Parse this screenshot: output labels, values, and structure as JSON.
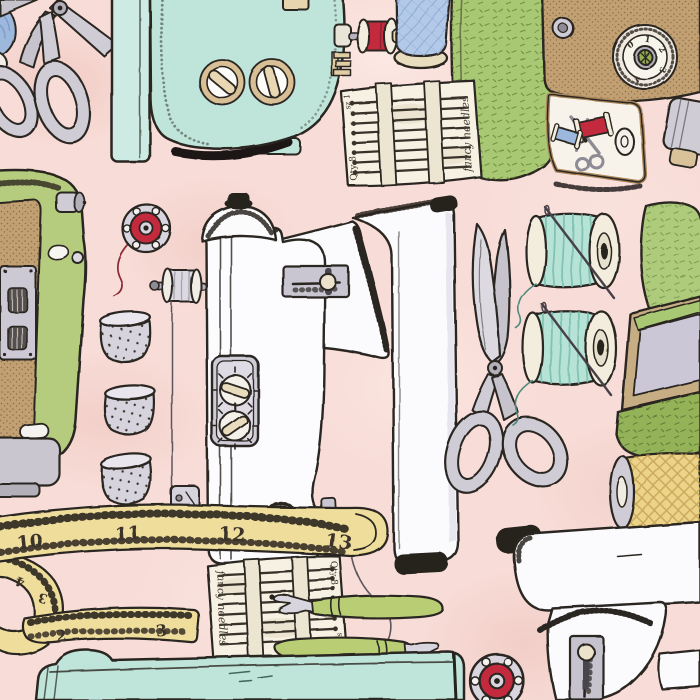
{
  "artwork": {
    "title": "Hand-drawn vintage sewing notions pattern on pink",
    "background_color": "#f8dcd7",
    "palette": {
      "ink": "#2a2520",
      "pink_background": "#f8dcd7",
      "teal_machine": "#bfe5da",
      "aqua_thread": "#b7e3d7",
      "avocado_green": "#b5cc7e",
      "olive_green": "#94b359",
      "leaf_green": "#a9c873",
      "brown": "#c2a072",
      "tan": "#e6d5ae",
      "cream": "#f6f1e3",
      "silver": "#cfccd6",
      "lavender": "#cbc7d6",
      "red": "#c32b3e",
      "blue": "#9db8dd",
      "yellow": "#efdd9b"
    },
    "needle_packet": {
      "qty_label": "Qty 8",
      "size_label": "sz 1",
      "brand_label": "fancy needles"
    },
    "tape_measure": {
      "top_numbers": [
        "10",
        "11",
        "12",
        "13"
      ],
      "loop_numbers": [
        "4",
        "3"
      ],
      "end_numbers": [
        "2",
        "3"
      ]
    },
    "case_dial_numbers": [
      "0",
      "1",
      "2",
      "3",
      "4"
    ],
    "items": [
      {
        "name": "tailor-shears-top-left",
        "description": "gray shears handles, upper left corner"
      },
      {
        "name": "teal-sewing-machine-top",
        "description": "aqua machine body with two tan dials, upside down"
      },
      {
        "name": "small-red-spool",
        "description": "red thread spool on pin"
      },
      {
        "name": "blue-thread-cone",
        "description": "blue thread cone with tan base"
      },
      {
        "name": "needle-packet-top",
        "description": "paper packet of 8 needles"
      },
      {
        "name": "sewing-case-top-right",
        "description": "brown case with numbered dial, green lid, open tray with mini scissors and spools"
      },
      {
        "name": "green-sewing-machine-left",
        "description": "avocado and tan machine, cut by left edge"
      },
      {
        "name": "red-metal-bobbin",
        "description": "metal bobbin with red thread and tail"
      },
      {
        "name": "three-thimbles",
        "description": "column of three dotted silver thimbles"
      },
      {
        "name": "white-sewing-machine-center",
        "description": "large white machine rotated, spool pin, slider plate, two-dial panel, needle with thread"
      },
      {
        "name": "tailor-shears-right",
        "description": "large gray shears pointing up"
      },
      {
        "name": "aqua-thread-spools",
        "description": "two aqua spools pierced by needles"
      },
      {
        "name": "green-sewing-box-right",
        "description": "open green box with lavender lining and pincushion"
      },
      {
        "name": "yellow-thread-spool",
        "description": "yellow crosshatched spool, right edge"
      },
      {
        "name": "tape-measure",
        "description": "yellow measuring tape in an S curl"
      },
      {
        "name": "needle-packet-bottom",
        "description": "second needle packet rotated 180 degrees"
      },
      {
        "name": "seam-rippers",
        "description": "two green-handled seam rippers"
      },
      {
        "name": "white-sewing-machine-bottom-right",
        "description": "white machine corner with slider plate"
      },
      {
        "name": "teal-machine-base-bottom",
        "description": "teal machine base strip along bottom edge"
      }
    ]
  }
}
